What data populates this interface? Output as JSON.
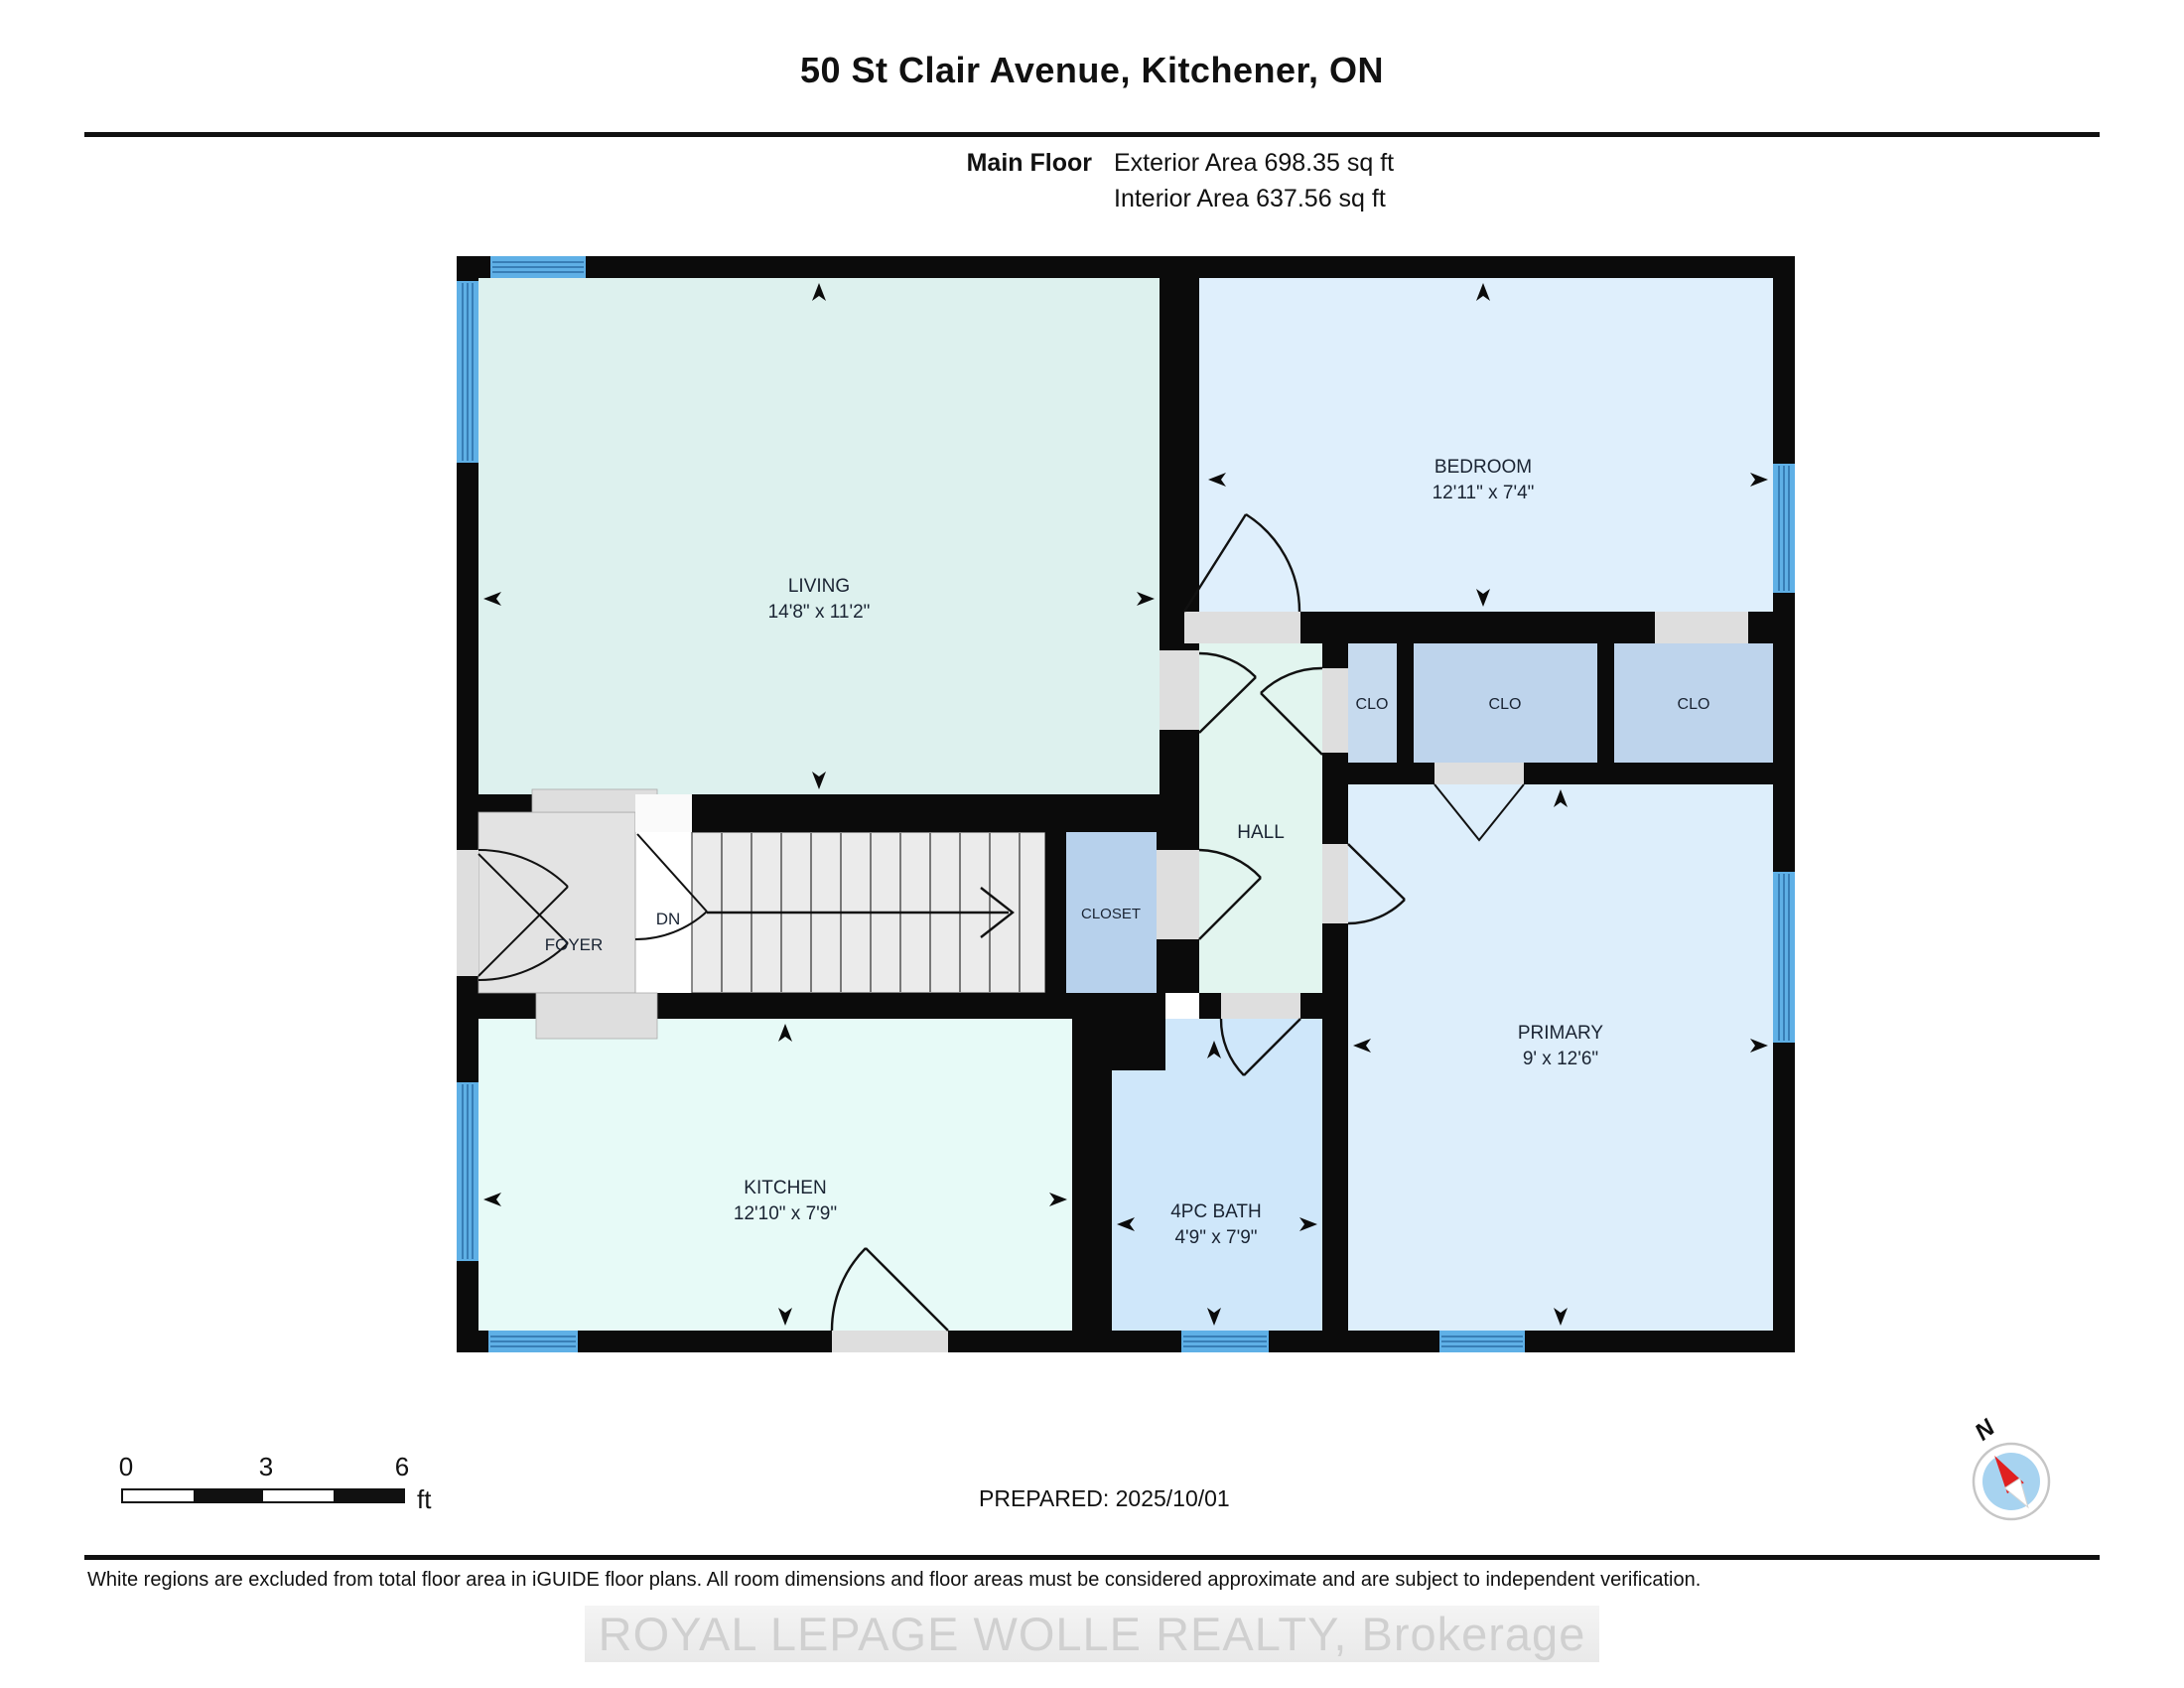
{
  "header": {
    "title": "50 St Clair Avenue, Kitchener, ON",
    "floor_label": "Main Floor",
    "exterior_area": "Exterior Area 698.35 sq ft",
    "interior_area": "Interior Area 637.56 sq ft"
  },
  "plan": {
    "living": {
      "name": "LIVING",
      "dims": "14'8\" x 11'2\""
    },
    "bedroom": {
      "name": "BEDROOM",
      "dims": "12'11\" x 7'4\""
    },
    "hall": {
      "name": "HALL"
    },
    "clo": "CLO",
    "closet": {
      "name": "CLOSET"
    },
    "foyer": {
      "name": "FOYER"
    },
    "stairs_label": "DN",
    "kitchen": {
      "name": "KITCHEN",
      "dims": "12'10\" x 7'9\""
    },
    "bath": {
      "name": "4PC BATH",
      "dims": "4'9\" x 7'9\""
    },
    "primary": {
      "name": "PRIMARY",
      "dims": "9' x 12'6\""
    }
  },
  "scale_bar": {
    "zero": "0",
    "three": "3",
    "six": "6",
    "unit": "ft"
  },
  "compass": {
    "label": "N"
  },
  "footer": {
    "prepared": "PREPARED: 2025/10/01",
    "disclaimer": "White regions are excluded from total floor area in iGUIDE floor plans. All room dimensions and floor areas must be considered approximate and are subject to independent verification.",
    "watermark": "ROYAL LEPAGE WOLLE REALTY, Brokerage"
  },
  "colors": {
    "wall": "#0b0b0b",
    "window": "#5fb0e6",
    "living": "#ddf1ee",
    "bedroom": "#dfeffc",
    "hall": "#e2f5ef",
    "kitchen": "#e7faf7",
    "bath": "#cfe7fa",
    "primary": "#ddeefb",
    "clo": "#bed4ec",
    "closet_blue": "#b7d1ec",
    "foyer": "#e3e3e3"
  }
}
